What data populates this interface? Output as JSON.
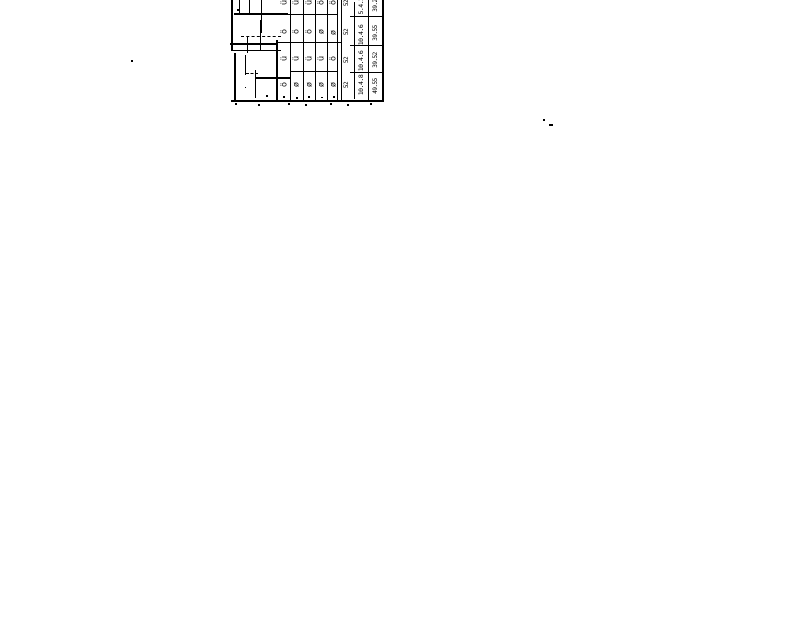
{
  "colors": {
    "ink": "#000000",
    "paper": "#ffffff"
  },
  "rows": [
    {
      "g": [
        "ü",
        "ü",
        "ü",
        "ö",
        "ö"
      ],
      "a": "52",
      "b": "5.4.2",
      "c": "39.25"
    },
    {
      "g": [
        "ö",
        "ö",
        "ö",
        "ø",
        "ø"
      ],
      "a": "52",
      "b": "10.4.6",
      "c": "39.55"
    },
    {
      "g": [
        "ü",
        "ü",
        "ü",
        "ü",
        "ö"
      ],
      "a": "52",
      "b": "10.4.6",
      "c": "39.52"
    },
    {
      "g": [
        "ö",
        "ø",
        "ø",
        "ø",
        "ø"
      ],
      "a": "52",
      "b": "10.4.8",
      "c": "49.55"
    }
  ]
}
